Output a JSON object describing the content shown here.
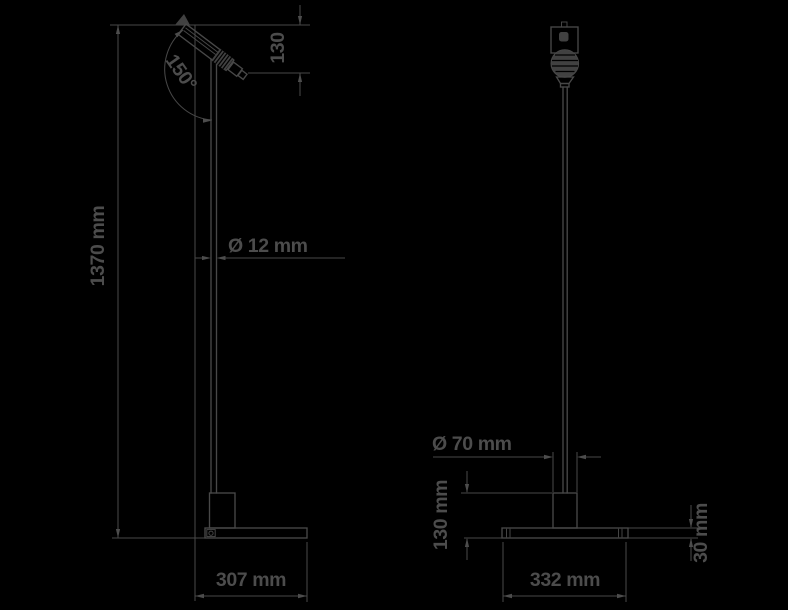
{
  "drawing": {
    "background": "#000000",
    "ink_color": "#484848",
    "type": "technical-dimension-drawing-floor-lamp",
    "side_view": {
      "dimensions": {
        "tilt_angle": "150°",
        "head_length": "130",
        "overall_height": "1370 mm",
        "pole_diameter": "Ø 12 mm",
        "base_depth": "307 mm"
      }
    },
    "front_view": {
      "dimensions": {
        "column_diameter": "Ø 70 mm",
        "base_height": "130 mm",
        "base_width": "332 mm",
        "plate_thickness": "30 mm"
      }
    }
  }
}
